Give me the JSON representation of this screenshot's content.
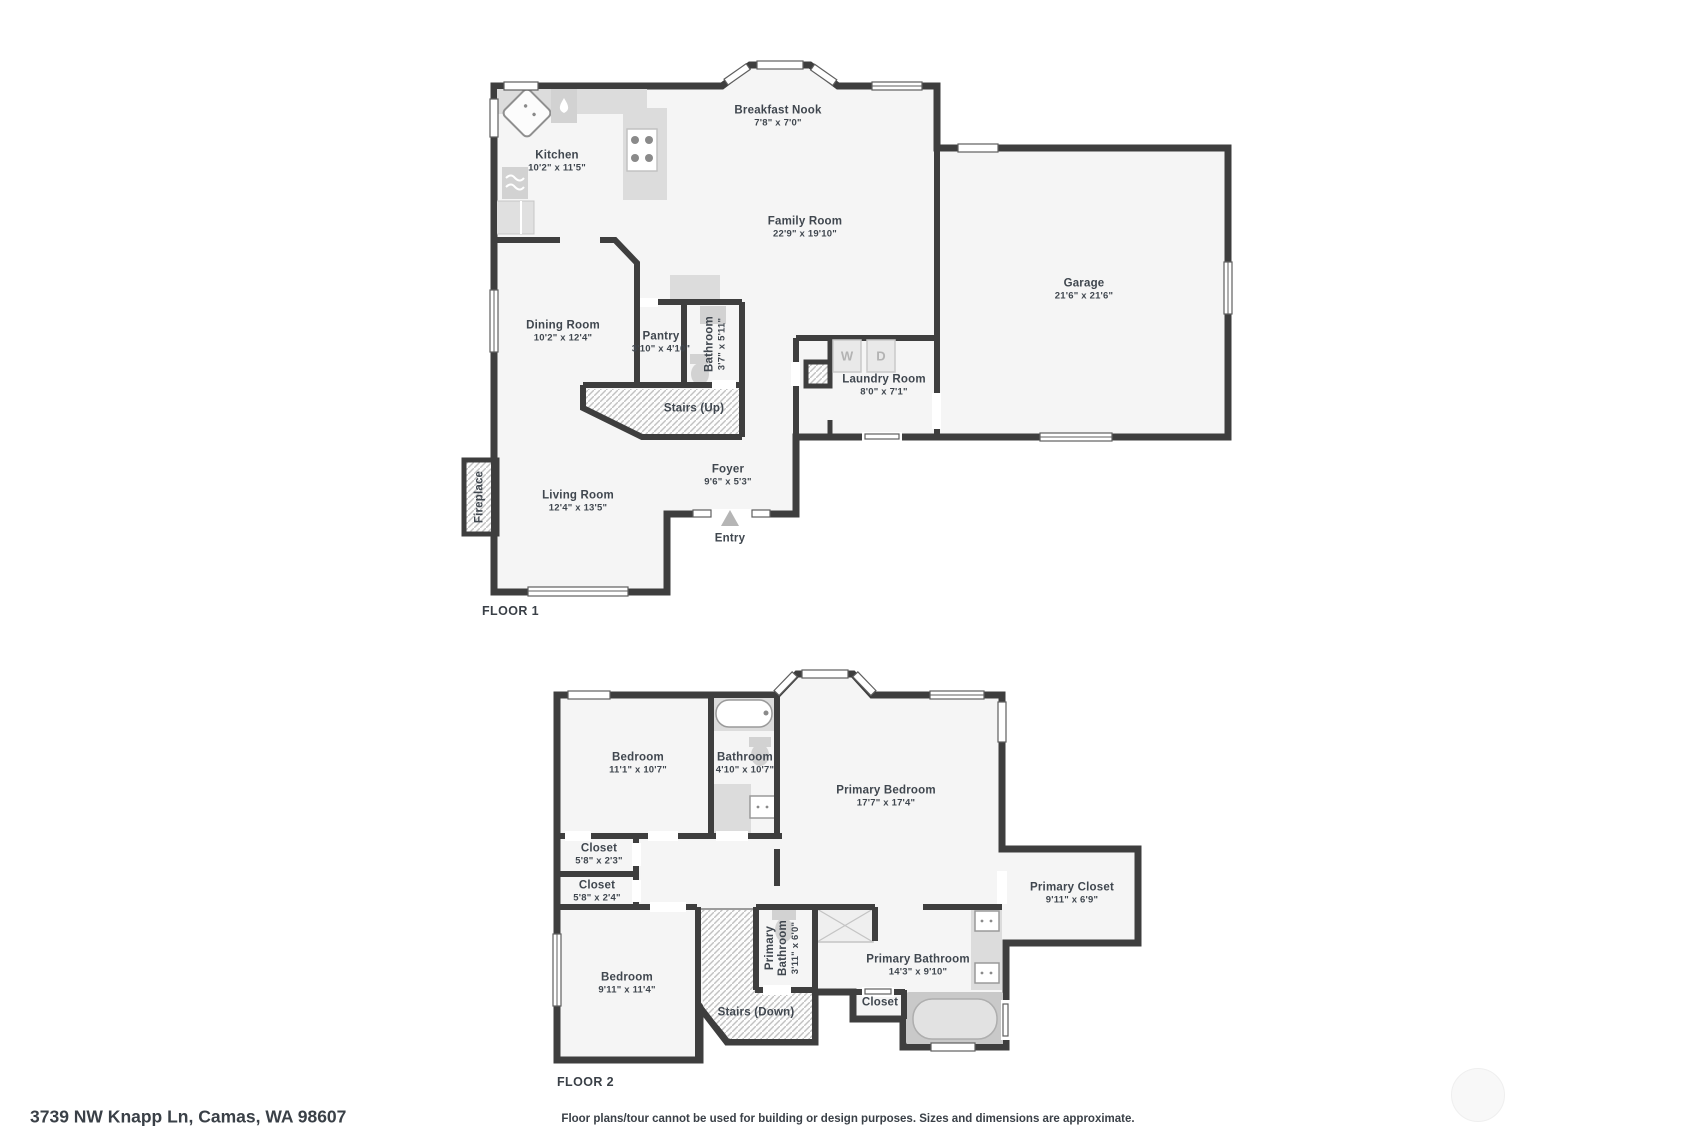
{
  "palette": {
    "wall_color": "#3e3e3e",
    "room_fill": "#f5f5f5",
    "text_color": "#40474f",
    "fixture_gray": "#dcdcdc",
    "hatch_line": "#bdbdbd",
    "appliance_letter": "#b3b3b3",
    "entry_arrow": "#b5b5b5"
  },
  "floor1": {
    "label": "FLOOR 1",
    "rooms": {
      "breakfast_nook": {
        "name": "Breakfast Nook",
        "dims": "7'8\" x 7'0\""
      },
      "kitchen": {
        "name": "Kitchen",
        "dims": "10'2\" x 11'5\""
      },
      "family_room": {
        "name": "Family Room",
        "dims": "22'9\" x 19'10\""
      },
      "garage": {
        "name": "Garage",
        "dims": "21'6\" x 21'6\""
      },
      "dining_room": {
        "name": "Dining Room",
        "dims": "10'2\" x 12'4\""
      },
      "pantry": {
        "name": "Pantry",
        "dims": "3'10\" x 4'10\""
      },
      "bathroom": {
        "name": "Bathroom",
        "dims": "3'7\" x 5'11\""
      },
      "laundry_room": {
        "name": "Laundry Room",
        "dims": "8'0\" x 7'1\""
      },
      "stairs": {
        "name": "Stairs (Up)"
      },
      "foyer": {
        "name": "Foyer",
        "dims": "9'6\" x 5'3\""
      },
      "living_room": {
        "name": "Living Room",
        "dims": "12'4\" x 13'5\""
      },
      "fireplace": {
        "name": "Fireplace"
      },
      "entry": {
        "name": "Entry"
      },
      "washer_label": "W",
      "dryer_label": "D"
    }
  },
  "floor2": {
    "label": "FLOOR 2",
    "rooms": {
      "bedroom_1": {
        "name": "Bedroom",
        "dims": "11'1\" x 10'7\""
      },
      "bathroom": {
        "name": "Bathroom",
        "dims": "4'10\" x 10'7\""
      },
      "primary_bedroom": {
        "name": "Primary Bedroom",
        "dims": "17'7\" x 17'4\""
      },
      "closet_1": {
        "name": "Closet",
        "dims": "5'8\" x 2'3\""
      },
      "closet_2": {
        "name": "Closet",
        "dims": "5'8\" x 2'4\""
      },
      "primary_closet": {
        "name": "Primary Closet",
        "dims": "9'11\" x 6'9\""
      },
      "bedroom_2": {
        "name": "Bedroom",
        "dims": "9'11\" x 11'4\""
      },
      "primary_bathroom_wc": {
        "name": "Primary Bathroom",
        "dims": "3'11\" x 6'0\""
      },
      "primary_bathroom": {
        "name": "Primary Bathroom",
        "dims": "14'3\" x 9'10\""
      },
      "closet_3": {
        "name": "Closet"
      },
      "stairs": {
        "name": "Stairs (Down)"
      }
    }
  },
  "footer": {
    "address": "3739 NW Knapp Ln, Camas, WA 98607",
    "disclaimer": "Floor plans/tour cannot be used for building or design purposes. Sizes and dimensions are approximate."
  }
}
